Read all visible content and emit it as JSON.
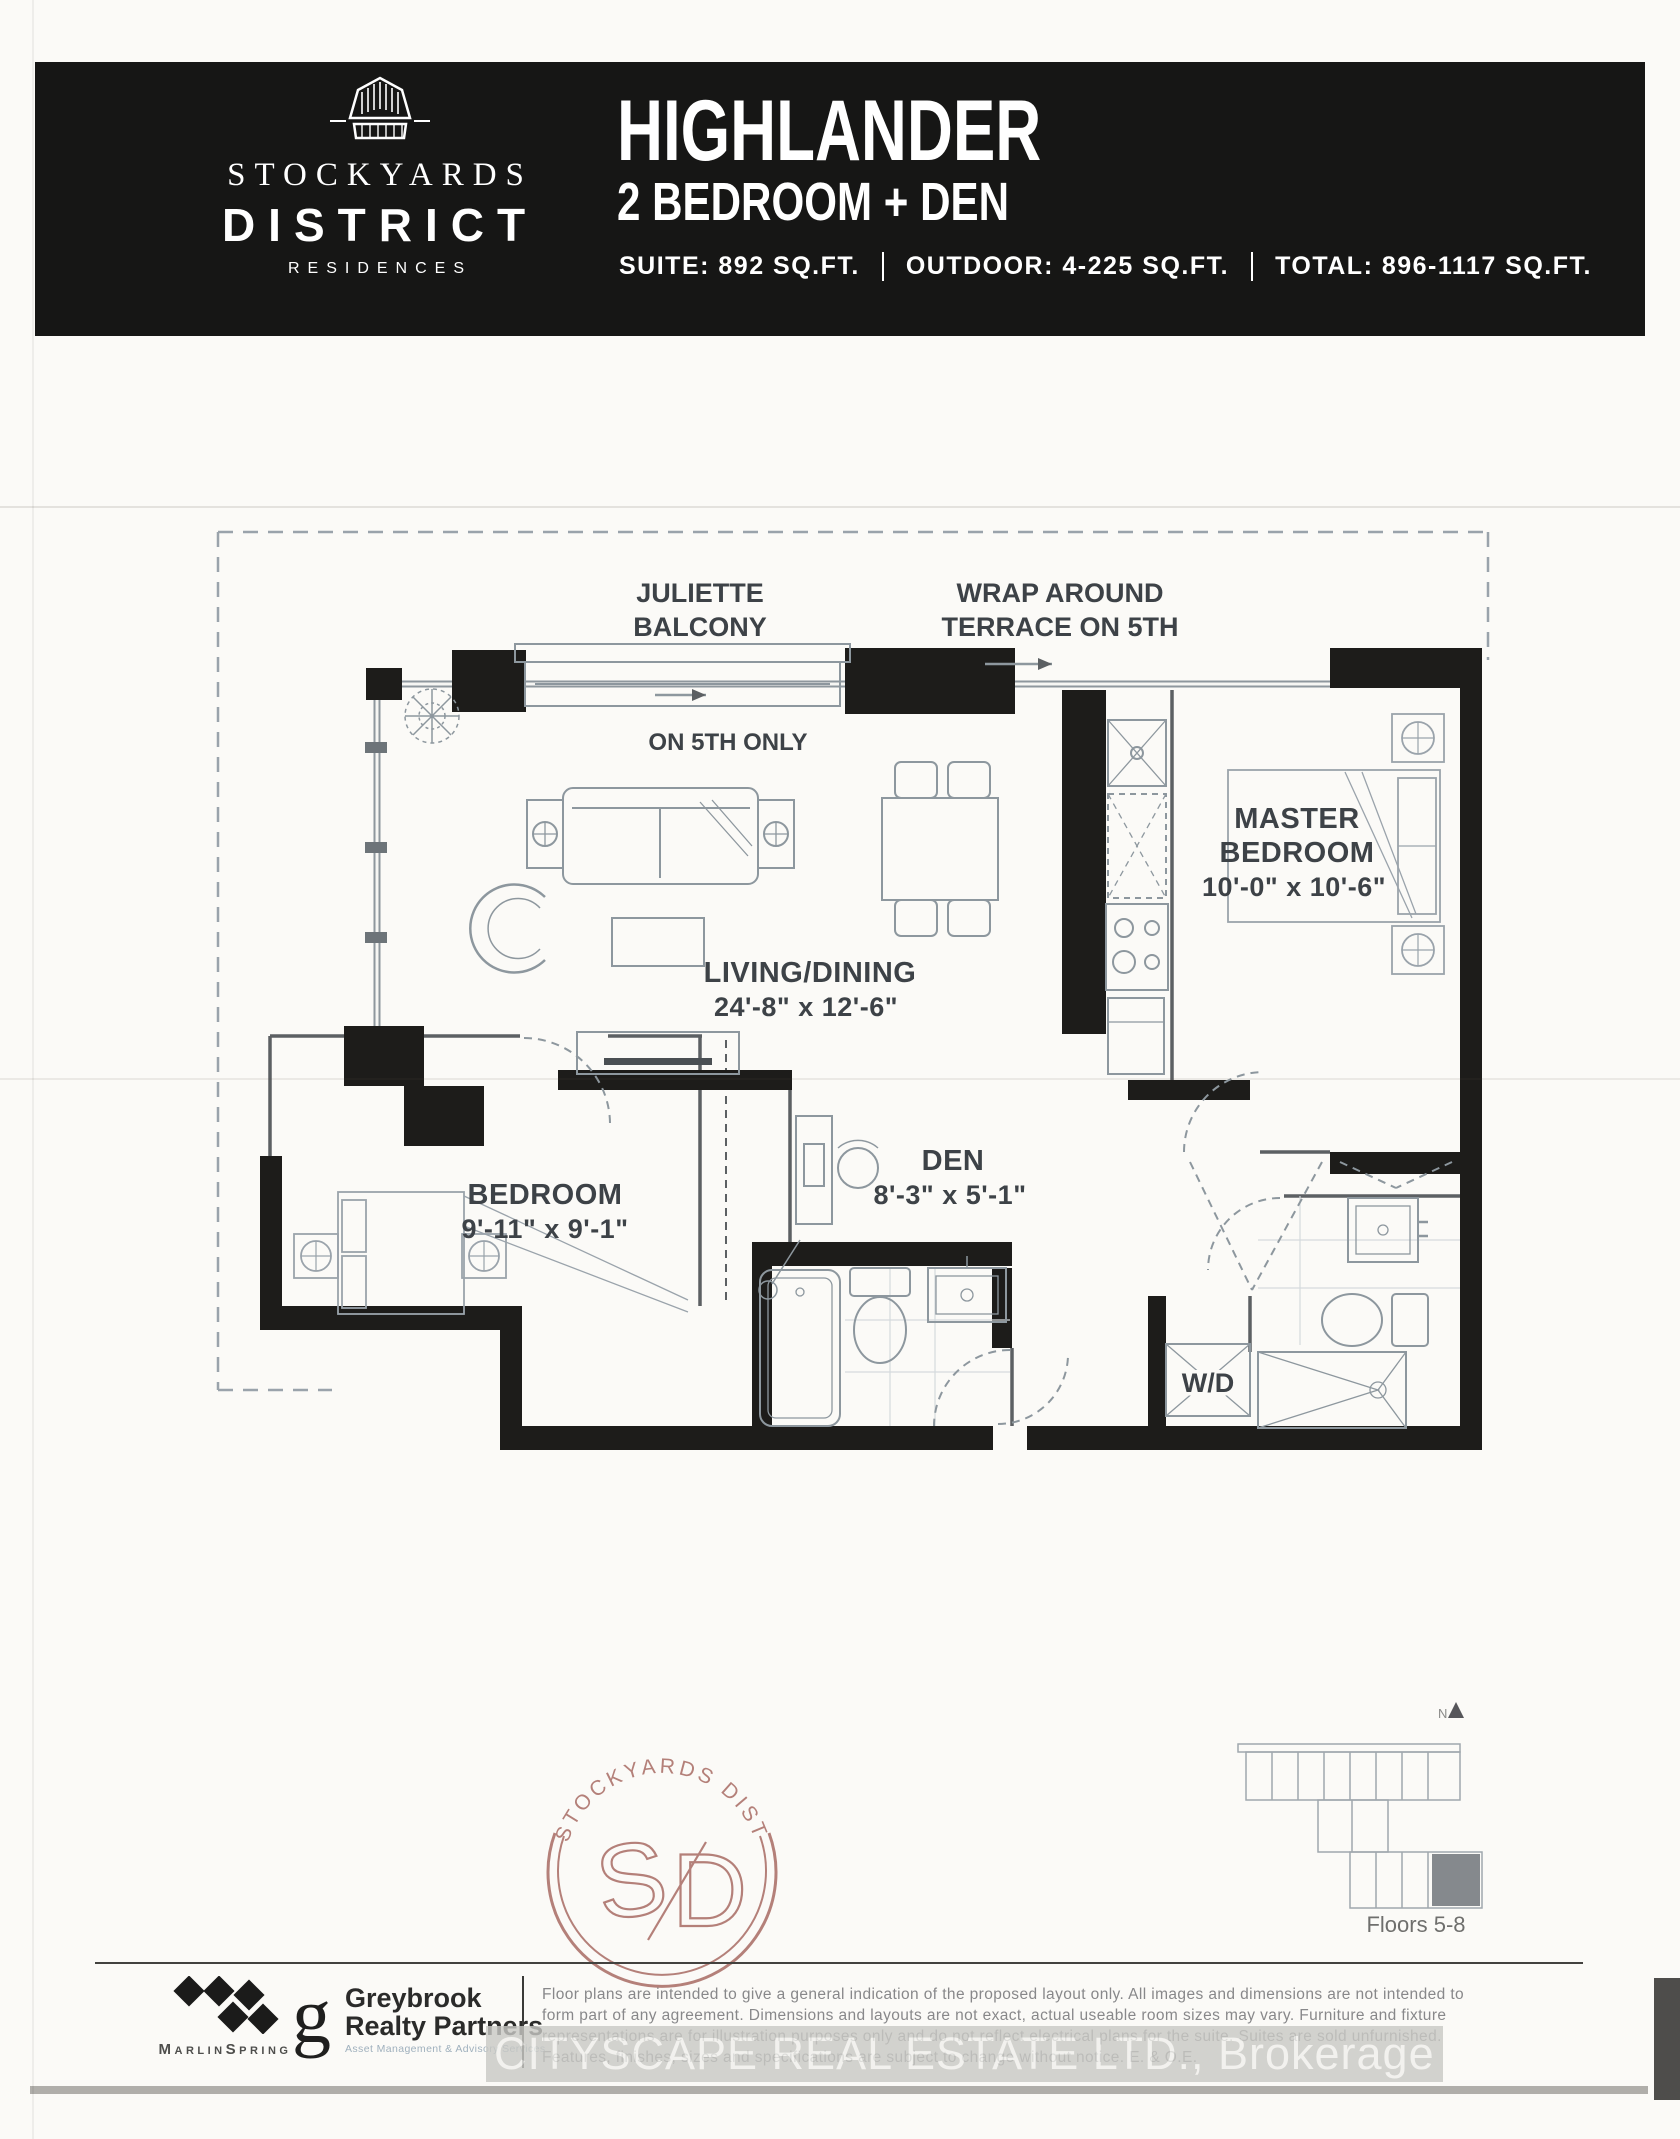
{
  "header": {
    "brand": {
      "name1": "STOCKYARDS",
      "name2": "DISTRICT",
      "name3": "RESIDENCES"
    },
    "plan_name": "HIGHLANDER",
    "plan_type": "2 BEDROOM + DEN",
    "stats": [
      "SUITE: 892 SQ.FT.",
      "OUTDOOR: 4-225 SQ.FT.",
      "TOTAL: 896-1117 SQ.FT."
    ]
  },
  "plan": {
    "juliette": [
      "JULIETTE",
      "BALCONY"
    ],
    "terrace": [
      "WRAP AROUND",
      "TERRACE ON 5TH"
    ],
    "on_5th_only": "ON 5TH ONLY",
    "rooms": {
      "living": {
        "name": "LIVING/DINING",
        "dims": "24'-8\" x 12'-6\""
      },
      "master": {
        "name1": "MASTER",
        "name2": "BEDROOM",
        "dims": "10'-0\" x 10'-6\""
      },
      "den": {
        "name": "DEN",
        "dims": "8'-3\" x 5'-1\""
      },
      "bedroom": {
        "name": "BEDROOM",
        "dims": "9'-11\" x 9'-1\""
      },
      "laundry": {
        "name": "W/D"
      }
    }
  },
  "keyplan": {
    "caption": "Floors 5-8",
    "north_label": "N"
  },
  "seal": {
    "arc_text": "STOCKYARDS  DISTRICT",
    "monogram_s": "S",
    "monogram_d": "D",
    "color": "#a86b64"
  },
  "footer": {
    "marlinspring": "MarlinSpring",
    "greybrook_initial": "g",
    "greybrook_line1": "Greybrook",
    "greybrook_line2": "Realty Partners",
    "greybrook_sub": "Asset Management & Advisory Services",
    "disclaimer": [
      "Floor plans are intended to give a general indication of the proposed layout only. All images and dimensions are not intended to",
      "form part of any agreement. Dimensions and layouts are not exact, actual useable room sizes may vary. Furniture and fixture",
      "representations are for illustration purposes only and do not reflect electrical plans for the suite. Suites are sold unfurnished.",
      "Features, finishes, sizes and specifications are subject to change without notice. E. & O.E."
    ]
  },
  "watermark": "CITYSCAPE REAL ESTATE LTD., Brokerage"
}
